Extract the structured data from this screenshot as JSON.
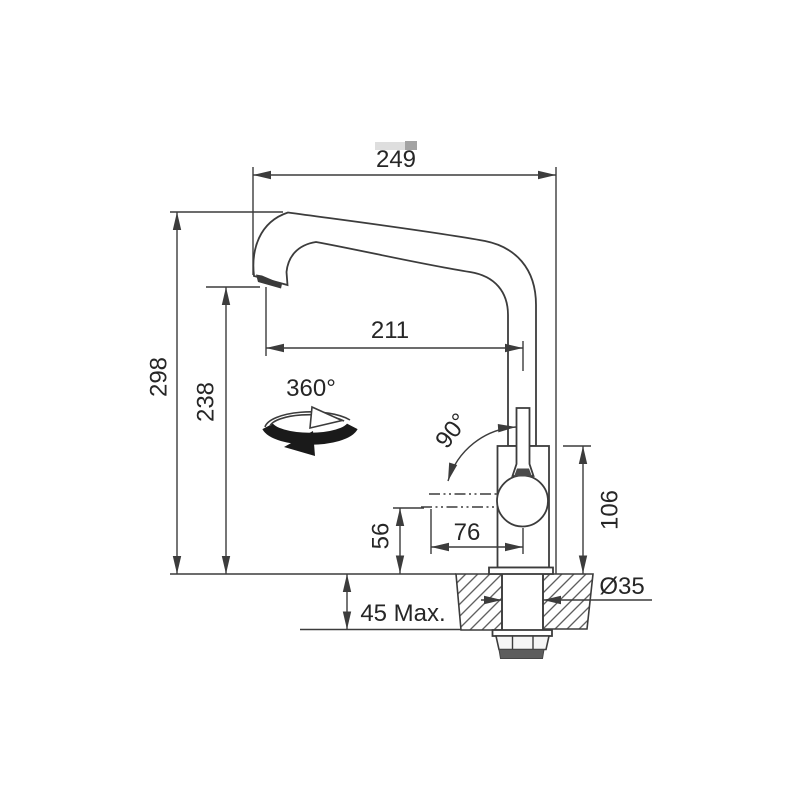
{
  "drawing": {
    "title": "Kitchen mixer tap installation dimensions (side view)",
    "dims": {
      "spout_reach_total": "249",
      "spout_reach_outlet": "211",
      "height_overall": "298",
      "height_outlet": "238",
      "body_height": "106",
      "outlet_axis_height": "56",
      "body_to_axis_offset": "76",
      "deck_thickness_max": "45 Max.",
      "hole_diameter": "Ø35",
      "swivel_range": "360°",
      "handle_swing": "90°"
    },
    "icons": {
      "rotation_360": "rotation-360-icon",
      "handle_arc": "angle-arc-icon"
    },
    "colors": {
      "line": "#3c3c3c",
      "text": "#262626",
      "fill": "#ffffff",
      "gasket": "#5d5d5d",
      "rotation_band": "#1a1a1a",
      "artifact_light": "#dedede",
      "artifact_dark": "#a3a3a3"
    }
  }
}
